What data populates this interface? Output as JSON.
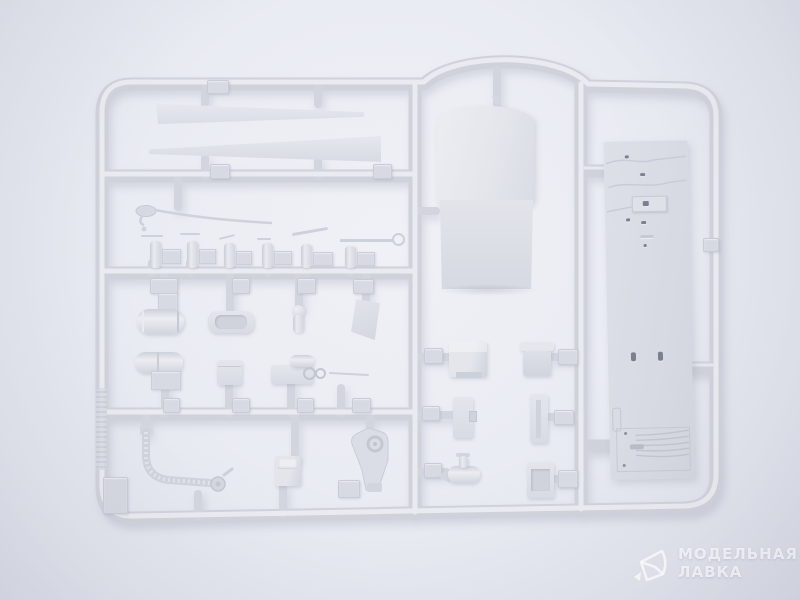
{
  "meta": {
    "type": "photograph",
    "subject": "Unpainted light-gray injection-molded plastic sprue (model kit parts tree) photographed on a light studio background"
  },
  "palette": {
    "background": "#eaecf3",
    "background_edge": "#d8dae4",
    "sprue": "#cfd2db",
    "sprue_highlight": "#e9ebf0",
    "part_light": "#e6e8ee",
    "part_mid": "#dcdfe6",
    "part_shadow": "#c7cad4",
    "engraving_dark": "#7b8090",
    "watermark": "#ffffff"
  },
  "watermark": {
    "logo": "crystal-logo",
    "line1": "МОДЕЛЬНАЯ",
    "line2": "ЛАВКА"
  },
  "parts": [
    "sprue-frame",
    "rotor-blade-upper",
    "rotor-blade-lower",
    "antenna-rod",
    "small-fitting-1",
    "small-fitting-2",
    "small-fitting-3",
    "small-fitting-4",
    "small-fitting-5",
    "small-fitting-6",
    "muffler-cylinder",
    "storage-tray",
    "dome-cylinder",
    "angled-plate",
    "twin-tank",
    "small-box",
    "gun-mount",
    "exhaust-pipe",
    "open-box",
    "pivot-bracket",
    "cab-canopy",
    "cab-front-panel",
    "seat",
    "door-panel",
    "cone-cylinder",
    "lid-box",
    "tall-panel",
    "recessed-box",
    "deck-panel",
    "sprue-letter-tag",
    "mold-text-strip"
  ]
}
